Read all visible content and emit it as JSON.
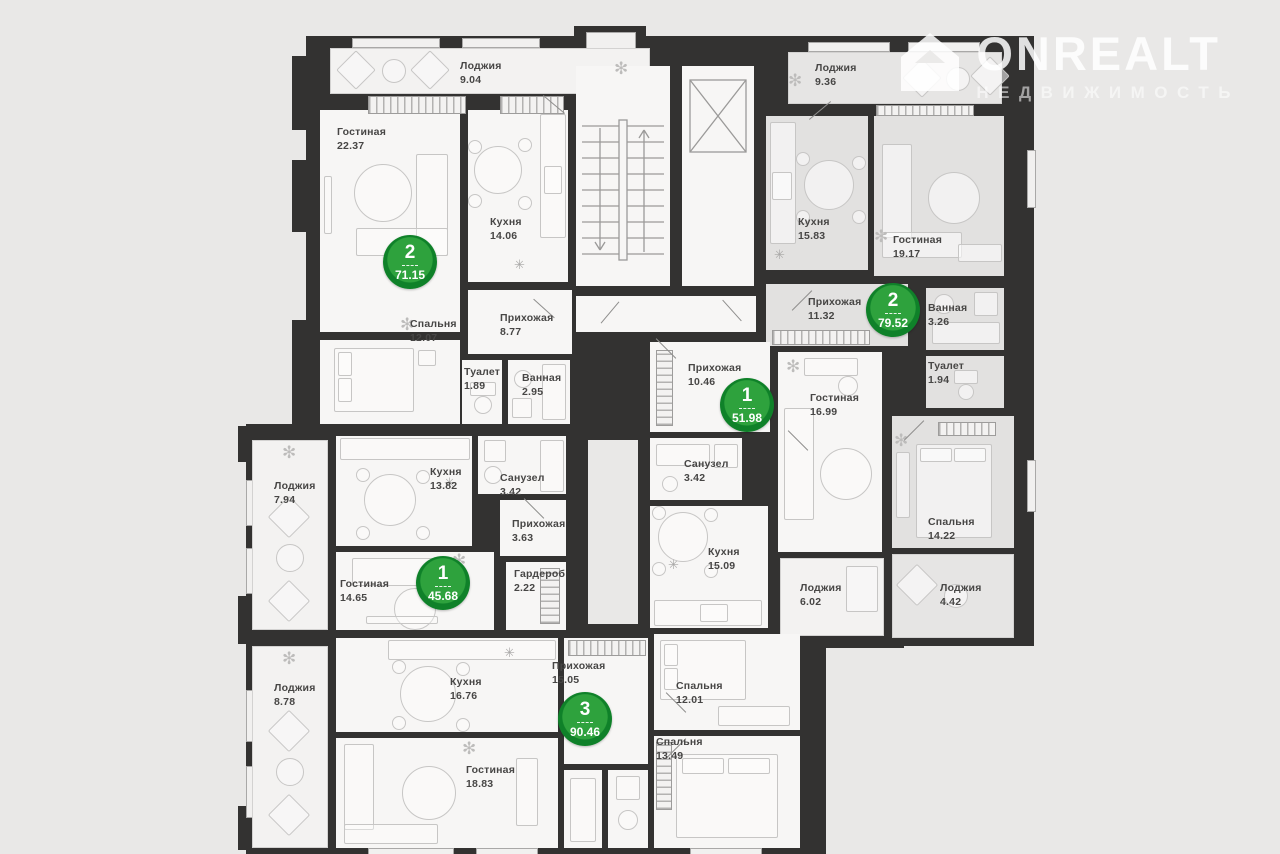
{
  "logo": {
    "brand": "ONREALT",
    "subtitle": "НЕДВИЖИМОСТЬ"
  },
  "colors": {
    "background": "#e9e8e7",
    "wall": "#333231",
    "room_floor": "#f7f6f5",
    "highlight_floor": "#e2e1e0",
    "badge_green_inner": "#2ea23d",
    "badge_green_ring": "#0f8129"
  },
  "apartments": [
    {
      "number": "2",
      "total_area": "71.15",
      "rooms": [
        {
          "name": "Лоджия",
          "area": "9.04"
        },
        {
          "name": "Гостиная",
          "area": "22.37"
        },
        {
          "name": "Кухня",
          "area": "14.06"
        },
        {
          "name": "Спальня",
          "area": "12.07"
        },
        {
          "name": "Прихожая",
          "area": "8.77"
        },
        {
          "name": "Туалет",
          "area": "1.89"
        },
        {
          "name": "Ванная",
          "area": "2.95"
        }
      ]
    },
    {
      "number": "2",
      "total_area": "79.52",
      "rooms": [
        {
          "name": "Лоджия",
          "area": "9.36"
        },
        {
          "name": "Кухня",
          "area": "15.83"
        },
        {
          "name": "Гостиная",
          "area": "19.17"
        },
        {
          "name": "Прихожая",
          "area": "11.32"
        },
        {
          "name": "Ванная",
          "area": "3.26"
        },
        {
          "name": "Туалет",
          "area": "1.94"
        },
        {
          "name": "Спальня",
          "area": "14.22"
        },
        {
          "name": "Лоджия",
          "area": "4.42"
        }
      ]
    },
    {
      "number": "1",
      "total_area": "51.98",
      "rooms": [
        {
          "name": "Прихожая",
          "area": "10.46"
        },
        {
          "name": "Гостиная",
          "area": "16.99"
        },
        {
          "name": "Санузел",
          "area": "3.42"
        },
        {
          "name": "Кухня",
          "area": "15.09"
        },
        {
          "name": "Лоджия",
          "area": "6.02"
        }
      ]
    },
    {
      "number": "1",
      "total_area": "45.68",
      "rooms": [
        {
          "name": "Лоджия",
          "area": "7.94"
        },
        {
          "name": "Кухня",
          "area": "13.82"
        },
        {
          "name": "Санузел",
          "area": "3.42"
        },
        {
          "name": "Прихожая",
          "area": "3.63"
        },
        {
          "name": "Гостиная",
          "area": "14.65"
        },
        {
          "name": "Гардероб",
          "area": "2.22"
        }
      ]
    },
    {
      "number": "3",
      "total_area": "90.46",
      "rooms": [
        {
          "name": "Лоджия",
          "area": "8.78"
        },
        {
          "name": "Кухня",
          "area": "16.76"
        },
        {
          "name": "Прихожая",
          "area": "15.05"
        },
        {
          "name": "Гостиная",
          "area": "18.83"
        },
        {
          "name": "Спальня",
          "area": "12.01"
        },
        {
          "name": "Спальня",
          "area": "13.49"
        }
      ]
    }
  ],
  "icons": {
    "plant": "✻",
    "vent": "✳"
  }
}
